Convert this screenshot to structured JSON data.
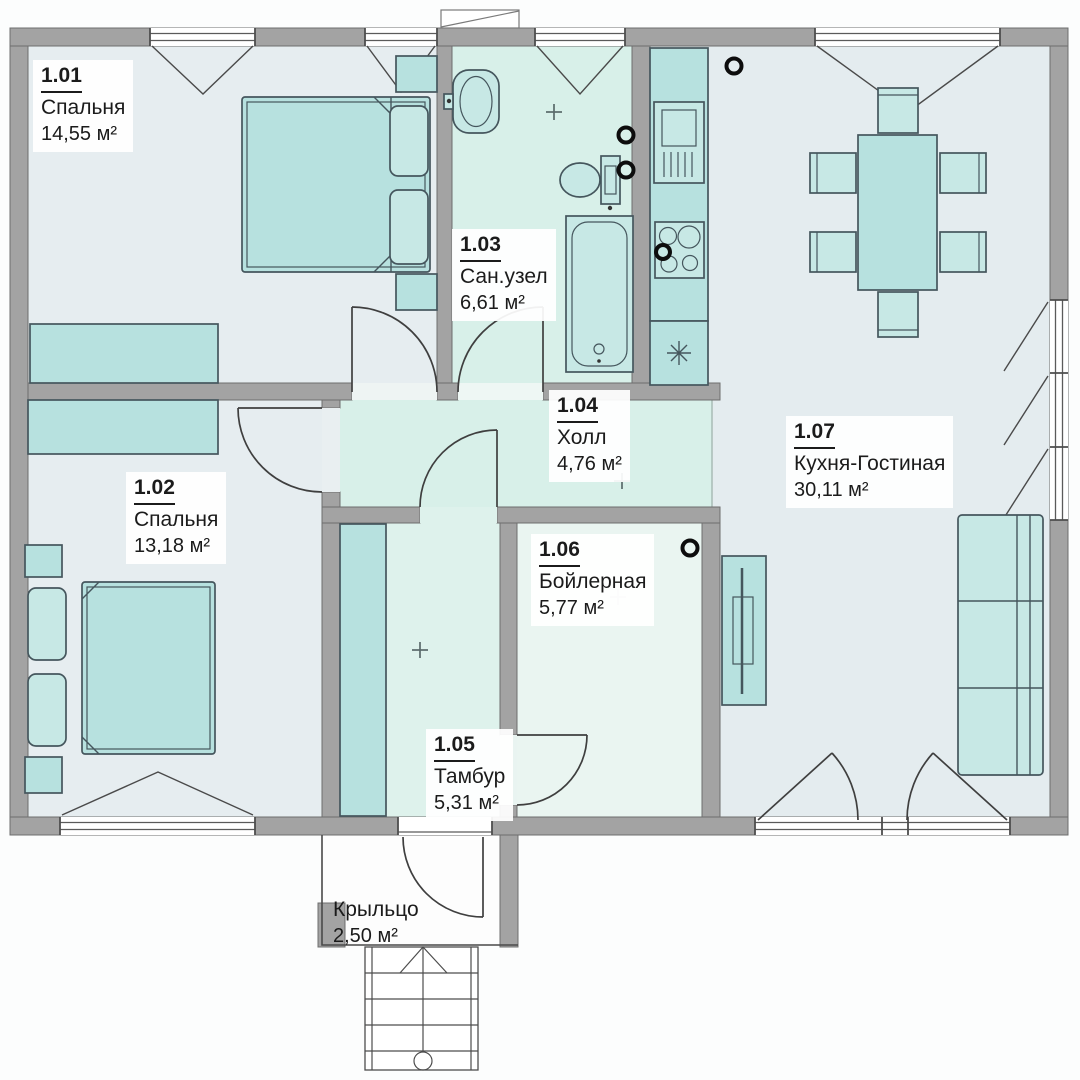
{
  "plan": {
    "rooms": [
      {
        "id": "1.01",
        "name": "Спальня",
        "area": "14,55 м²"
      },
      {
        "id": "1.02",
        "name": "Спальня",
        "area": "13,18 м²"
      },
      {
        "id": "1.03",
        "name": "Сан.узел",
        "area": "6,61 м²"
      },
      {
        "id": "1.04",
        "name": "Холл",
        "area": "4,76 м²"
      },
      {
        "id": "1.05",
        "name": "Тамбур",
        "area": "5,31 м²"
      },
      {
        "id": "1.06",
        "name": "Бойлерная",
        "area": "5,77 м²"
      },
      {
        "id": "1.07",
        "name": "Кухня-Гостиная",
        "area": "30,11 м²"
      }
    ],
    "porch": {
      "name": "Крыльцо",
      "area": "2,50 м²"
    },
    "colors": {
      "wall_gray": "#a3a3a3",
      "furniture_teal": "#b7e1df",
      "furniture_teal_light": "#c7e8e5",
      "floor_blue_gray": "#e6edf0",
      "floor_mint": "#d8f0e9",
      "label_text": "#1b1b1b"
    }
  }
}
